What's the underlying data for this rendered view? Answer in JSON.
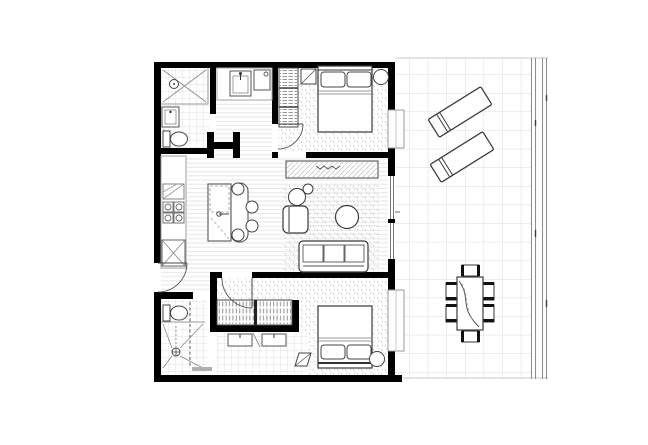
{
  "image": {
    "title": "two-bedroom-apartment-floor-plan-with-terrace",
    "width": 648,
    "height": 445,
    "background": "#ffffff"
  },
  "palette": {
    "wall": "#000000",
    "furniture_line": "#3a3a3a",
    "light_line": "#999999",
    "floor_tile": "#e2e2e2",
    "floorboard": "#e6e6e6",
    "carpet_dot": "#c2c2c2",
    "terrace_grid": "#dadada",
    "balustrade": "#8f8f8f",
    "threshold": "#b0b0b0"
  },
  "floor_plan": {
    "rooms": [
      {
        "id": "bathroom-1",
        "features": [
          "shower",
          "vanity",
          "toilet"
        ]
      },
      {
        "id": "laundry-nook",
        "features": [
          "sink",
          "appliance"
        ]
      },
      {
        "id": "bedroom-1",
        "features": [
          "double-bed",
          "wardrobe",
          "bedside-table",
          "bedside-round-table",
          "window",
          "door"
        ]
      },
      {
        "id": "hallway",
        "features": [
          "linen-closet"
        ]
      },
      {
        "id": "kitchen",
        "features": [
          "rangehood",
          "cooktop-4-burner",
          "refrigerator",
          "island-bench",
          "breakfast-bar",
          "stools-x4"
        ]
      },
      {
        "id": "living-dining",
        "features": [
          "tv-unit",
          "armchair",
          "plant",
          "coffee-table",
          "sofa-3-seat",
          "rug",
          "glass-sliding-door"
        ]
      },
      {
        "id": "bedroom-2",
        "features": [
          "double-bed",
          "built-in-wardrobe",
          "drawers-x2",
          "bedside-round-table",
          "window",
          "door"
        ]
      },
      {
        "id": "bathroom-2",
        "features": [
          "toilet",
          "shower",
          "shower-screen"
        ]
      },
      {
        "id": "entry",
        "features": [
          "entry-door"
        ]
      },
      {
        "id": "terrace",
        "features": [
          "tiled-floor",
          "sun-lounger-x2",
          "outdoor-dining-table",
          "dining-chairs-x6",
          "glass-balustrade"
        ]
      }
    ]
  }
}
